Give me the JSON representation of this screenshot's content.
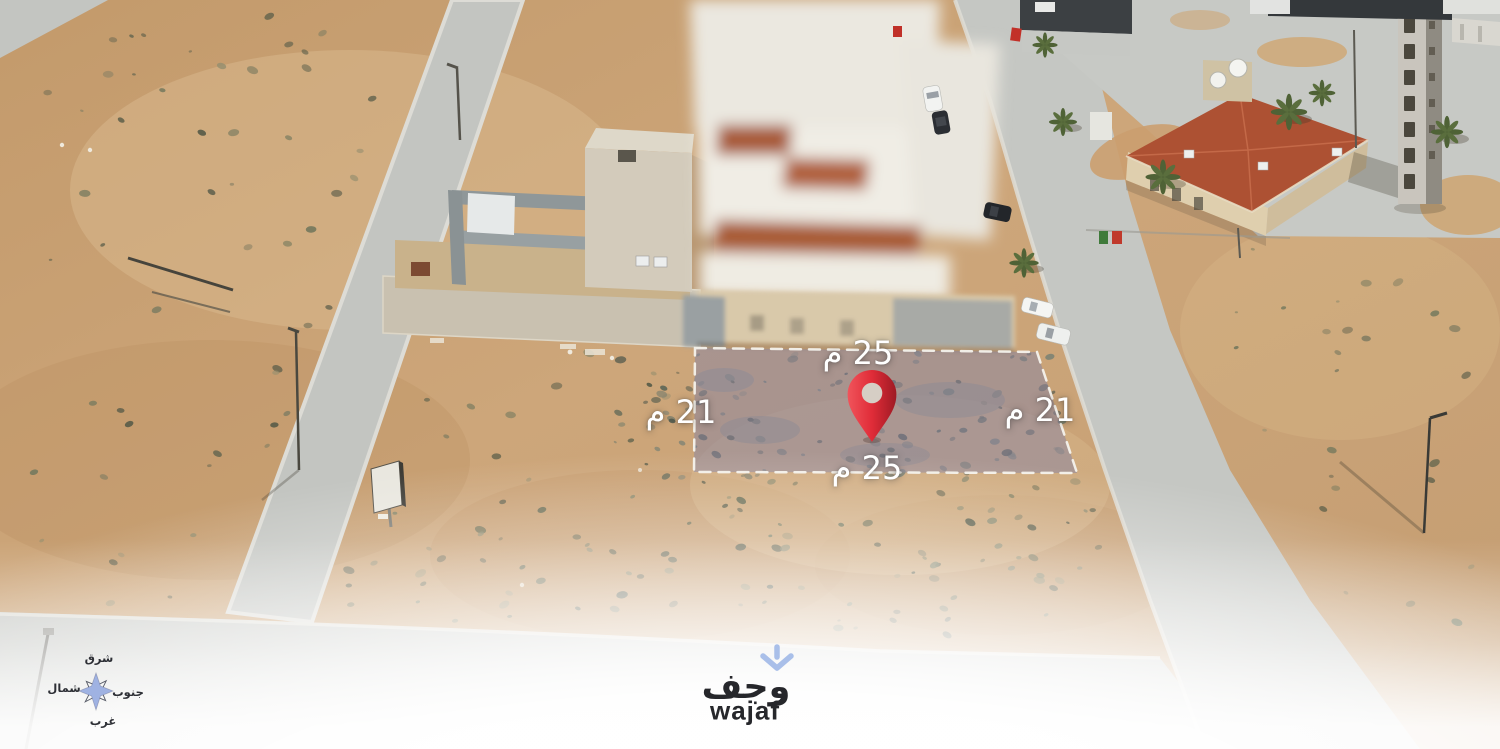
{
  "plot_overlay": {
    "fill_color": "#8d86a0",
    "border_color": "#f4f2ec",
    "pin_color": "#e02c38",
    "dimensions": {
      "top": "25 م",
      "bottom": "25 م",
      "left": "21 م",
      "right": "21 م"
    }
  },
  "compass": {
    "star_color": "#9fb2e2",
    "labels": {
      "top": "شرق",
      "left": "شمال",
      "right": "جنوب",
      "bottom": "غرب"
    }
  },
  "watermark": {
    "arabic_name": "وجف",
    "latin_name": "wajaf",
    "icon_color": "#a9bfe9"
  }
}
